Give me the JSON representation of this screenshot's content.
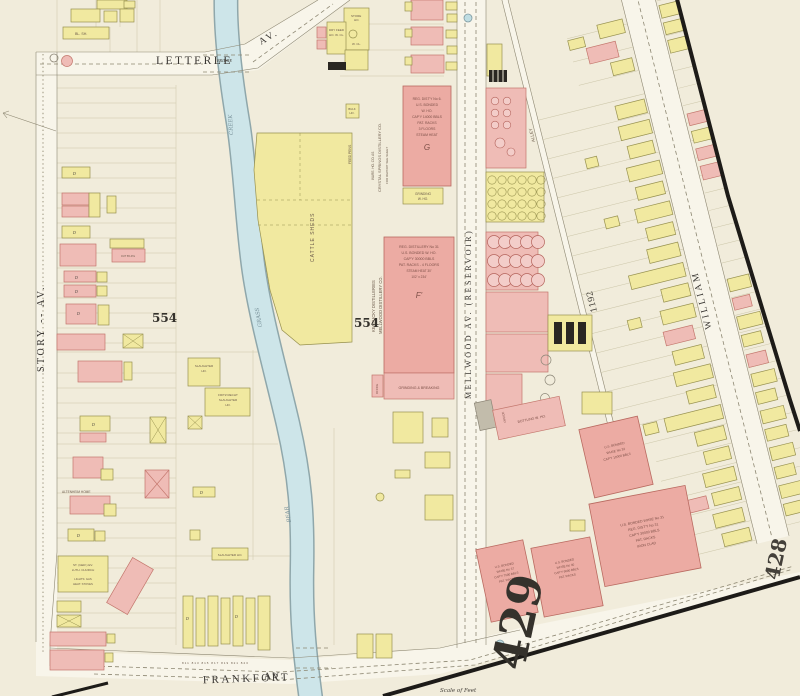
{
  "colors": {
    "paper": "#f1ecdb",
    "street": "#f8f5ea",
    "brick_pink": "#efbcb6",
    "frame_yellow": "#f1e9a0",
    "creek_blue": "#cde5e9",
    "border_black": "#1d1b18"
  },
  "streets": {
    "letterle": "LETTERLE",
    "letterle_av": "AV.",
    "bridge": "BRIDGE",
    "story": "STORY -- AV.",
    "frankfort": "FRANKFORT",
    "frankfort_av": "AV.",
    "mellwood": "MELLWOOD  AV.  (RESERVOIR)",
    "william": "WILLIAM",
    "alley": "ALLEY"
  },
  "creek": {
    "upper": "CREEK",
    "middle": "GRASS",
    "lower": "BEAR"
  },
  "numbers": {
    "block_west": "554",
    "block_east": "554",
    "sheet_main": "429",
    "sheet_next": "428",
    "house_1192": "1192",
    "row_numbers": "811  813  815  817  819  821  823"
  },
  "misc": {
    "scale_note": "Scale of Feet",
    "dwelling_marker": "D"
  },
  "labels": {
    "bl_sh": "BL. SH.",
    "store_ho": [
      "STORE",
      "HO.",
      "W. CL."
    ],
    "dry_feed": [
      "DRY FEED",
      "HO. W. CL."
    ],
    "bulk_ho": [
      "BULK",
      "HO."
    ],
    "feed_pen": "FEED PENS",
    "cattle_sheds": "CATTLE   SHEDS",
    "crystal": [
      "WARE. HO. CO. AS",
      "CRYSTAL SPRINGS DISTILLERY CO.",
      "FOR REPORT SEE SHEET"
    ],
    "reg6": [
      "REG. DIST'Y No 6.",
      "U.S. BONDED",
      "W. HO.",
      "CAP'Y 14000 BBLS",
      "PAT. RACKS",
      "3 FLOORS",
      "STEAM HEAT"
    ],
    "reg6_mark": "G",
    "grinding": [
      "GRINDING",
      "W. HO."
    ],
    "kentucky": [
      "KENTUCKY DISTILLERIES",
      "MELLWOOD DISTILLERY CO."
    ],
    "reg31": [
      "REG. DISTILLERY No 31",
      "U.S. BONDED W. HO.",
      "CAP'Y 30000 BBLS",
      "PAT. RACKS - 4 FLOORS",
      "STEAM HEAT 30'",
      "102' x 234'"
    ],
    "reg31_mark": "F'",
    "grind_break": "GRINDING & BREAKING",
    "office": "OFFICE",
    "bottling": "BOTTLING W. HO.",
    "slaughter": [
      "SLAUGHTER",
      "HO."
    ],
    "fritz": [
      "FRITZ RECHT",
      "SLAUGHTER",
      "HO."
    ],
    "slaughter2": "SLAUGHTER HO.",
    "altenheim": "ALTENHEIM HOME",
    "church": [
      "ST. (GER.) EV.",
      "LUTH. CHURCH",
      "LIGHTS: GAS",
      "HEAT: STOVES"
    ],
    "out_bldg": "OUT B'LD'G",
    "wh_upper": [
      "U.S. BONDED",
      "WHSE No 32",
      "CAP'Y 10000 BBLS"
    ],
    "wh_big": [
      "U.S. BONDED WHSE No 31",
      "REG. DIST'Y No 31",
      "CAP'Y 30000 BBLS",
      "PAT. RACKS",
      "IRON CLAD"
    ],
    "wh_left": [
      "U.S. BONDED",
      "WHSE No 37",
      "CAP'Y 7500 BBLS",
      "PAT. RACKS"
    ],
    "wh_mid": [
      "U.S. BONDED",
      "WHSE No 30",
      "CAP'Y 9000 BBLS",
      "PAT. RACKS"
    ]
  }
}
